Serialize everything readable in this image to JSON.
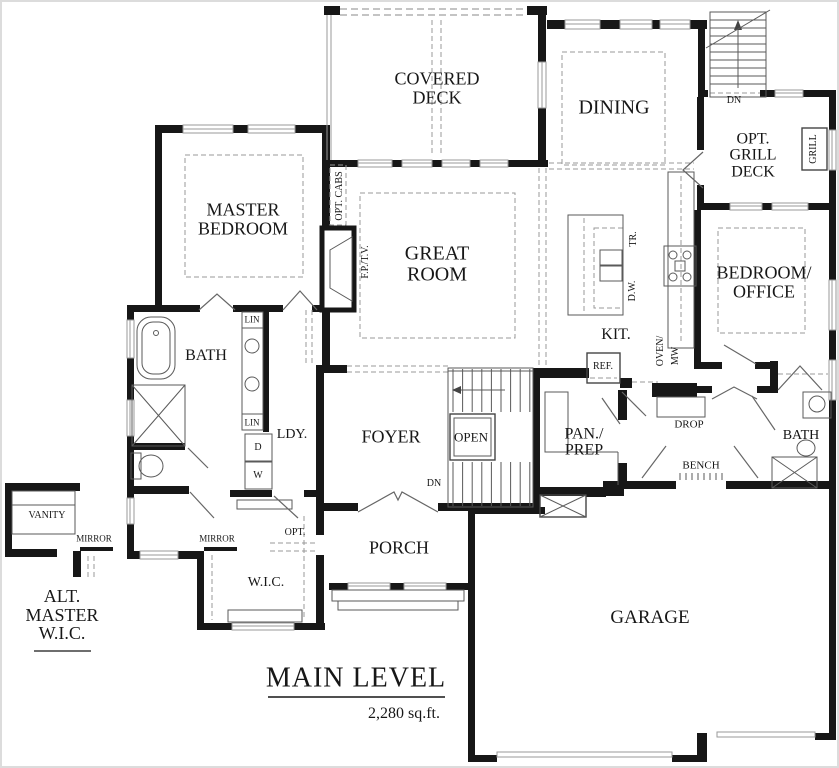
{
  "drawing": {
    "plan_name": "MAIN LEVEL",
    "area_text": "2,280 sq.ft.",
    "labels": [
      {
        "name": "covered-deck",
        "text": "COVERED\nDECK",
        "x": 437,
        "y": 88,
        "fs": 18,
        "rot": 0
      },
      {
        "name": "dining",
        "text": "DINING",
        "x": 614,
        "y": 108,
        "fs": 20,
        "rot": 0
      },
      {
        "name": "dn-top-stairs",
        "text": "DN",
        "x": 734,
        "y": 101,
        "fs": 10,
        "rot": 0
      },
      {
        "name": "opt-grill-deck",
        "text": "OPT.\nGRILL\nDECK",
        "x": 753,
        "y": 156,
        "fs": 16,
        "rot": 0
      },
      {
        "name": "grill",
        "text": "GRILL",
        "x": 814,
        "y": 149,
        "fs": 10,
        "rot": -90
      },
      {
        "name": "master-bedroom",
        "text": "MASTER\nBEDROOM",
        "x": 243,
        "y": 219,
        "fs": 18,
        "rot": 0
      },
      {
        "name": "opt-cabs",
        "text": "OPT. CABS",
        "x": 340,
        "y": 196,
        "fs": 10,
        "rot": -90
      },
      {
        "name": "fp-tv",
        "text": "F.P./T.V.",
        "x": 366,
        "y": 262,
        "fs": 10,
        "rot": -90
      },
      {
        "name": "great-room",
        "text": "GREAT\nROOM",
        "x": 437,
        "y": 264,
        "fs": 20,
        "rot": 0
      },
      {
        "name": "tr",
        "text": "TR.",
        "x": 634,
        "y": 239,
        "fs": 10,
        "rot": -90
      },
      {
        "name": "dw",
        "text": "D.W.",
        "x": 633,
        "y": 291,
        "fs": 10,
        "rot": -90
      },
      {
        "name": "kit",
        "text": "KIT.",
        "x": 616,
        "y": 335,
        "fs": 16,
        "rot": 0
      },
      {
        "name": "oven",
        "text": "OVEN/",
        "x": 661,
        "y": 351,
        "fs": 10,
        "rot": -90
      },
      {
        "name": "mw",
        "text": "MW",
        "x": 676,
        "y": 356,
        "fs": 10,
        "rot": -90
      },
      {
        "name": "bedroom-office",
        "text": "BEDROOM/\nOFFICE",
        "x": 764,
        "y": 282,
        "fs": 18,
        "rot": 0
      },
      {
        "name": "bath-left",
        "text": "BATH",
        "x": 206,
        "y": 356,
        "fs": 16,
        "rot": 0
      },
      {
        "name": "lin-top",
        "text": "LIN",
        "x": 252,
        "y": 320,
        "fs": 9,
        "rot": 0
      },
      {
        "name": "lin-bottom",
        "text": "LIN",
        "x": 252,
        "y": 423,
        "fs": 9,
        "rot": 0
      },
      {
        "name": "ldy",
        "text": "LDY.",
        "x": 292,
        "y": 435,
        "fs": 14,
        "rot": 0
      },
      {
        "name": "dryer",
        "text": "D",
        "x": 258,
        "y": 448,
        "fs": 10,
        "rot": 0
      },
      {
        "name": "washer",
        "text": "W",
        "x": 258,
        "y": 476,
        "fs": 10,
        "rot": 0
      },
      {
        "name": "foyer",
        "text": "FOYER",
        "x": 391,
        "y": 437,
        "fs": 18,
        "rot": 0
      },
      {
        "name": "open",
        "text": "OPEN",
        "x": 471,
        "y": 437,
        "fs": 13,
        "rot": 0
      },
      {
        "name": "dn-foyer",
        "text": "DN",
        "x": 434,
        "y": 484,
        "fs": 10,
        "rot": 0
      },
      {
        "name": "pan-prep",
        "text": "PAN./\nPREP",
        "x": 584,
        "y": 443,
        "fs": 16,
        "rot": 0
      },
      {
        "name": "ref",
        "text": "REF.",
        "x": 603,
        "y": 367,
        "fs": 10,
        "rot": 0
      },
      {
        "name": "drop",
        "text": "DROP",
        "x": 689,
        "y": 425,
        "fs": 11,
        "rot": 0
      },
      {
        "name": "bench",
        "text": "BENCH",
        "x": 701,
        "y": 466,
        "fs": 11,
        "rot": 0
      },
      {
        "name": "bath-right",
        "text": "BATH",
        "x": 801,
        "y": 436,
        "fs": 14,
        "rot": 0
      },
      {
        "name": "vanity",
        "text": "VANITY",
        "x": 47,
        "y": 516,
        "fs": 10,
        "rot": 0
      },
      {
        "name": "mirror-left",
        "text": "MIRROR",
        "x": 94,
        "y": 539,
        "fs": 9,
        "rot": 0
      },
      {
        "name": "mirror-right",
        "text": "MIRROR",
        "x": 217,
        "y": 539,
        "fs": 9,
        "rot": 0
      },
      {
        "name": "opt",
        "text": "OPT.",
        "x": 295,
        "y": 533,
        "fs": 10,
        "rot": 0
      },
      {
        "name": "wic",
        "text": "W.I.C.",
        "x": 266,
        "y": 583,
        "fs": 14,
        "rot": 0
      },
      {
        "name": "alt-master-wic",
        "text": "ALT.\nMASTER\nW.I.C.",
        "x": 62,
        "y": 615,
        "fs": 18,
        "rot": 0
      },
      {
        "name": "porch",
        "text": "PORCH",
        "x": 399,
        "y": 548,
        "fs": 18,
        "rot": 0
      },
      {
        "name": "garage",
        "text": "GARAGE",
        "x": 650,
        "y": 618,
        "fs": 19,
        "rot": 0
      },
      {
        "name": "title-main-level",
        "text": "MAIN LEVEL",
        "x": 356,
        "y": 679,
        "fs": 28,
        "rot": 0,
        "ls": 1
      },
      {
        "name": "title-area",
        "text": "2,280 sq.ft.",
        "x": 404,
        "y": 714,
        "fs": 16,
        "rot": 0
      }
    ]
  }
}
